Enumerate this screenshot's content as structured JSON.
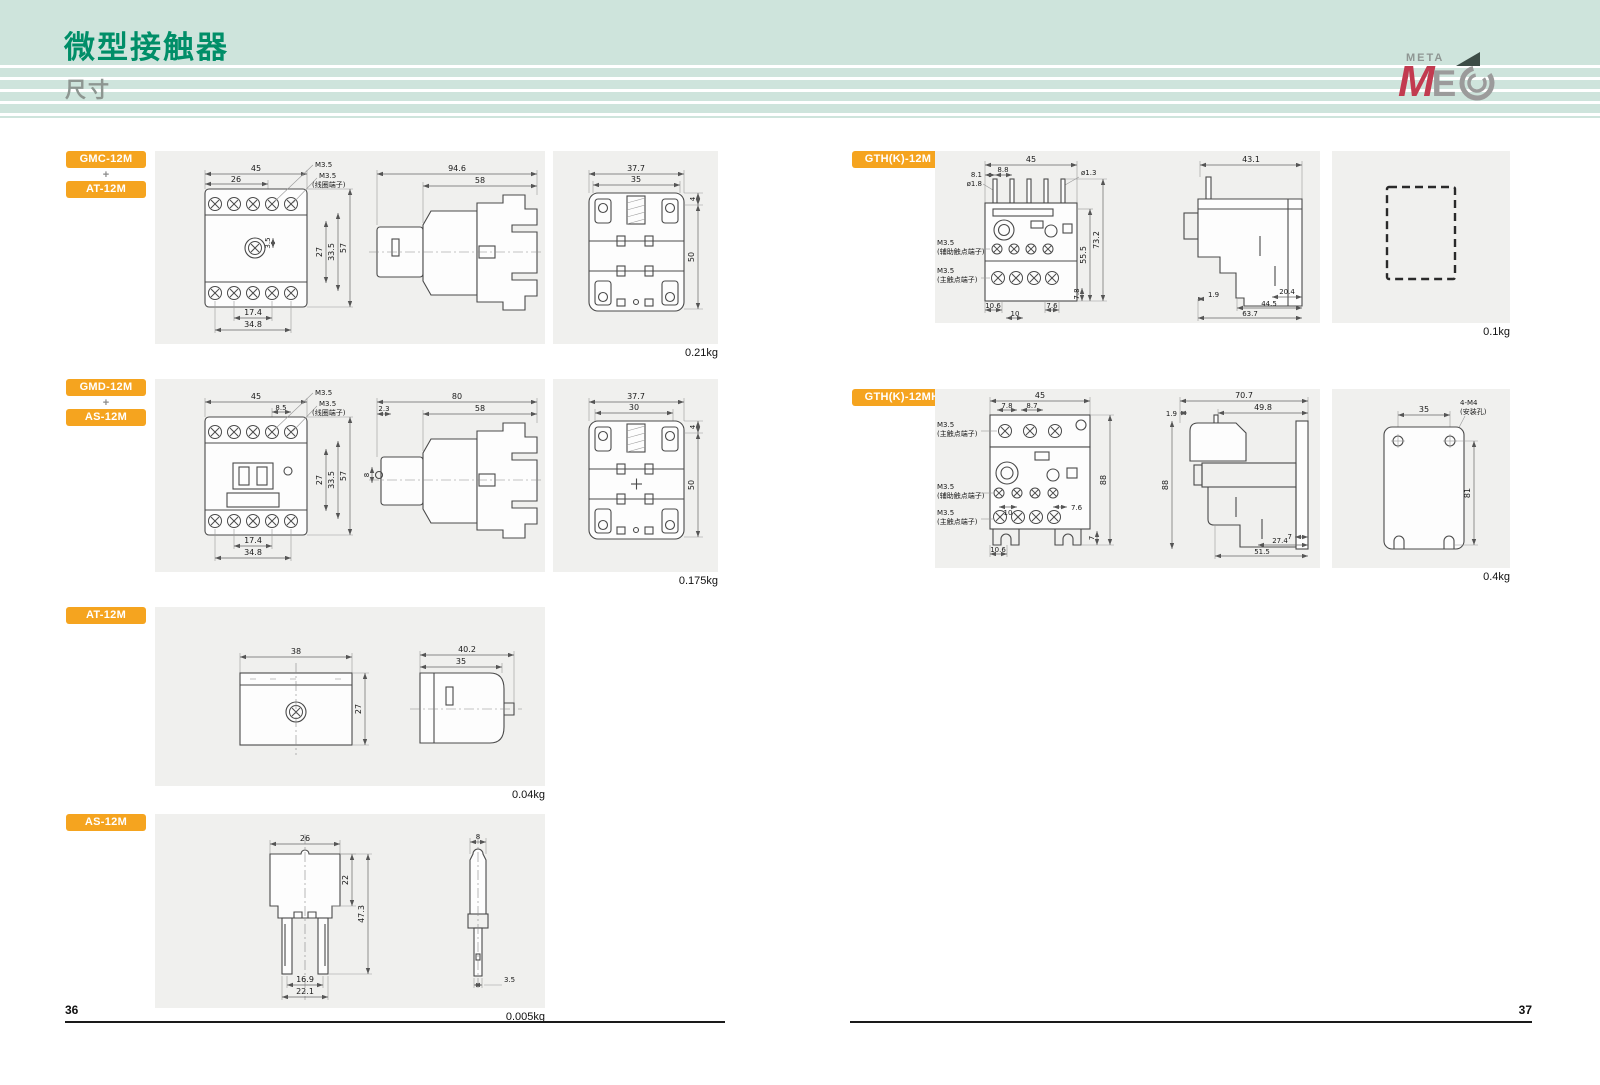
{
  "header": {
    "title": "微型接触器",
    "subtitle": "尺寸"
  },
  "logo": {
    "meta": "META",
    "m": "M",
    "e": "E"
  },
  "page": {
    "left_number": "36",
    "right_number": "37"
  },
  "blocks": {
    "gmc_at": {
      "chip1": "GMC-12M",
      "plus": "+",
      "chip2": "AT-12M",
      "weight": "0.21kg",
      "front": {
        "d45": "45",
        "d26": "26",
        "m35a": "M3.5",
        "m35b": "M3.5",
        "coil": "(线圈端子)",
        "d3_5": "3.5",
        "d27": "27",
        "d33_5": "33.5",
        "d57": "57",
        "d17_4": "17.4",
        "d34_8": "34.8"
      },
      "side": {
        "d94_6": "94.6",
        "d58": "58"
      },
      "rear": {
        "d37_7": "37.7",
        "d35": "35",
        "d4": "4",
        "d50": "50"
      }
    },
    "gmd_as": {
      "chip1": "GMD-12M",
      "plus": "+",
      "chip2": "AS-12M",
      "weight": "0.175kg",
      "front": {
        "d45": "45",
        "d8_5": "8.5",
        "m35a": "M3.5",
        "m35b": "M3.5",
        "coil": "(线圈端子)",
        "d27": "27",
        "d33_5": "33.5",
        "d57": "57",
        "d17_4": "17.4",
        "d34_8": "34.8"
      },
      "side": {
        "d80": "80",
        "d2_3": "2.3",
        "d58": "58",
        "d8": "8"
      },
      "rear": {
        "d37_7": "37.7",
        "d30": "30",
        "d4": "4",
        "d50": "50"
      }
    },
    "at": {
      "chip": "AT-12M",
      "weight": "0.04kg",
      "front": {
        "d38": "38",
        "d27": "27"
      },
      "side": {
        "d40_2": "40.2",
        "d35": "35"
      }
    },
    "as": {
      "chip": "AS-12M",
      "weight": "0.005kg",
      "front": {
        "d26": "26",
        "d22": "22",
        "d47_3": "47.3",
        "d16_9": "16.9",
        "d22_1": "22.1"
      },
      "side": {
        "d8": "8",
        "d3_5": "3.5"
      }
    },
    "g12m": {
      "chip": "GTH(K)-12M",
      "weight": "0.1kg",
      "front": {
        "d45": "45",
        "d8_1": "8.1",
        "dia1_8": "ø1.8",
        "d8_8": "8.8",
        "dia1_3": "ø1.3",
        "m35a": "M3.5",
        "aux": "(辅助触点端子)",
        "m35b": "M3.5",
        "main": "(主触点端子)",
        "d73_2": "73.2",
        "d55_5": "55.5",
        "d7_8": "7.8",
        "d10": "10",
        "d10_6": "10.6",
        "d7_6": "7.6"
      },
      "side": {
        "d43_1": "43.1",
        "d1_9": "1.9",
        "d20_4": "20.4",
        "d44_5": "44.5",
        "d63_7": "63.7"
      }
    },
    "g12mh": {
      "chip": "GTH(K)-12MH",
      "weight": "0.4kg",
      "front": {
        "d45": "45",
        "d7_8": "7.8",
        "d8_7": "8.7",
        "m35a": "M3.5",
        "main1": "(主触点端子)",
        "m35b": "M3.5",
        "aux": "(辅助触点端子)",
        "m35c": "M3.5",
        "main2": "(主触点端子)",
        "d88": "88",
        "d10": "10",
        "d7_6": "7.6",
        "d7": "7",
        "d10_6": "10.6"
      },
      "side": {
        "d70_7": "70.7",
        "d49_8": "49.8",
        "d1_9": "1.9",
        "d88": "88",
        "d7": "7",
        "d27_4": "27.4",
        "d51_5": "51.5"
      },
      "plate": {
        "d35": "35",
        "m4": "4-M4",
        "hole": "(安装孔)",
        "d81": "81"
      }
    }
  }
}
